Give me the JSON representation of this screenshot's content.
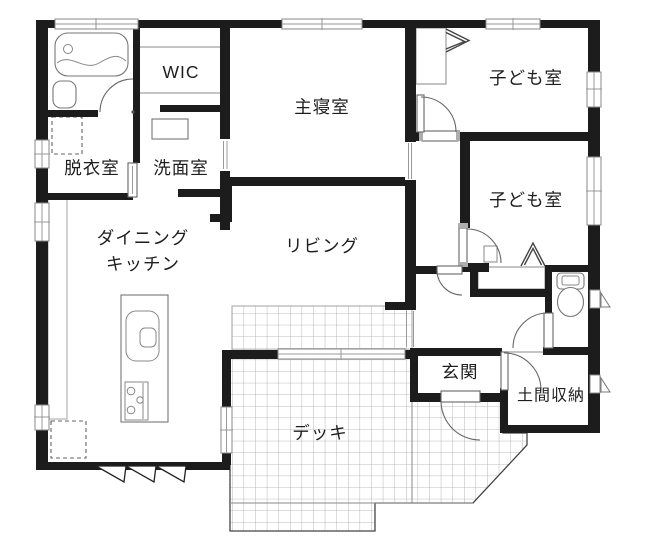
{
  "floorplan": {
    "rooms": {
      "wic": {
        "label": "WIC"
      },
      "master_bedroom": {
        "label": "主寝室"
      },
      "kids_room_1": {
        "label": "子ども室"
      },
      "kids_room_2": {
        "label": "子ども室"
      },
      "dressing_room": {
        "label": "脱衣室"
      },
      "washroom": {
        "label": "洗面室"
      },
      "dining_kitchen": {
        "label_line1": "ダイニング",
        "label_line2": "キッチン"
      },
      "living": {
        "label": "リビング"
      },
      "entrance": {
        "label": "玄関"
      },
      "doma_storage": {
        "label": "土間収納"
      },
      "deck": {
        "label": "デッキ"
      }
    },
    "colors": {
      "wall": "#1c1c1c",
      "fixture_line": "#777777",
      "tile_grid": "#a6a6a6",
      "label_text": "#1e1e1e",
      "background": "#ffffff"
    }
  }
}
